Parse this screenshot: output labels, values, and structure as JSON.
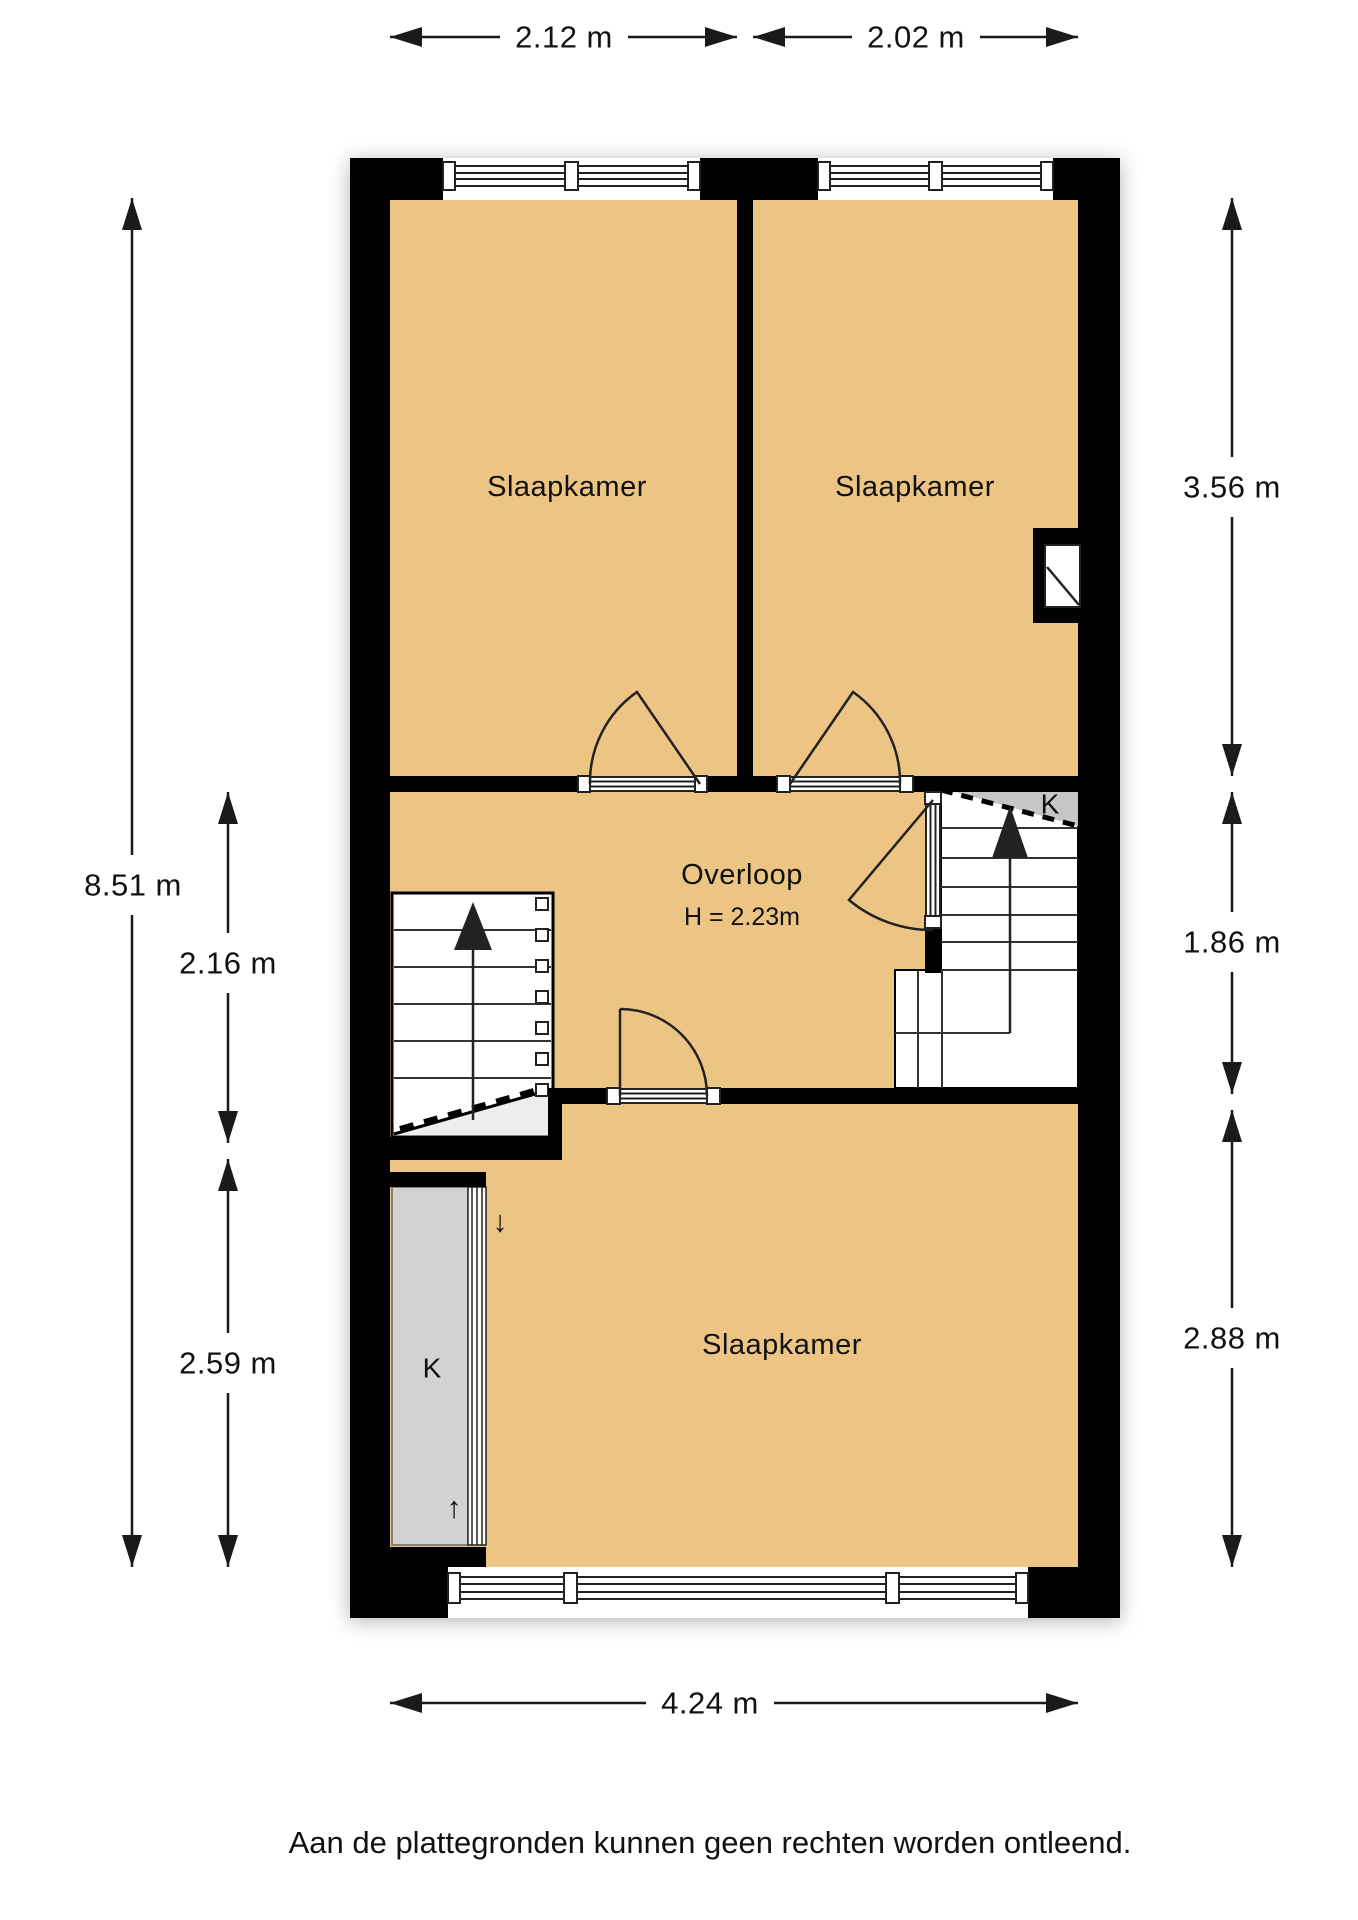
{
  "colors": {
    "room": "#ecc484",
    "closet": "#d2d2d2",
    "understairs": "#c6c6c6",
    "wall": "#000000"
  },
  "dims": {
    "top_left_width": "2.12 m",
    "top_right_width": "2.02 m",
    "left_total_height": "8.51 m",
    "left_mid_height": "2.16 m",
    "left_bottom_height": "2.59 m",
    "right_top_height": "3.56 m",
    "right_mid_height": "1.86 m",
    "right_bottom_height": "2.88 m",
    "bottom_total_width": "4.24 m"
  },
  "rooms": {
    "bedroom_top_left": "Slaapkamer",
    "bedroom_top_right": "Slaapkamer",
    "bedroom_bottom": "Slaapkamer",
    "landing": "Overloop",
    "landing_ceiling_height": "H = 2.23m",
    "closet_under_stairs": "K",
    "closet_bottom_left": "K"
  },
  "icons": {
    "arrow_down": "↓",
    "arrow_up": "↑"
  },
  "footer": {
    "disclaimer": "Aan de plattegronden kunnen geen rechten worden ontleend."
  }
}
